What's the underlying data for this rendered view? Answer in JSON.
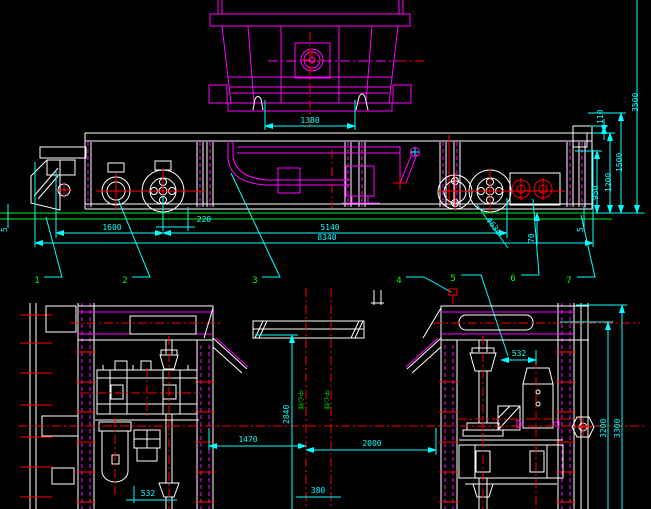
{
  "colors": {
    "background": "#000000",
    "structure_white": "#ffffff",
    "part_magenta": "#ff00ff",
    "dimension_cyan": "#00ffff",
    "centerline_red": "#ff0000",
    "ground_green": "#00ee00",
    "callout_green": "#00ff00"
  },
  "side_view": {
    "dims": {
      "hopper_seat_width": "1380",
      "axle_offset": "220",
      "end_overhang": "1600",
      "wheel_base": "5140",
      "overall_length": "8340",
      "overall_height": "3500",
      "lip_height": "110",
      "height_1500": "1500",
      "deck_height": "1200",
      "height_950": "950",
      "rail_gap_left": "5",
      "rail_gap_right": "5",
      "rail_head_height": "70",
      "wheel_diameter": "Φ630"
    },
    "callouts": [
      "1",
      "2",
      "3",
      "4",
      "5",
      "6",
      "7"
    ]
  },
  "end_view": {
    "dims": {
      "motor_offset": "532",
      "jack_offset": "532",
      "bay_width_left": "1470",
      "bay_width_right": "2000",
      "frame_height": "2840",
      "centerline_gap": "380",
      "inner_width": "3200",
      "outer_width": "3300"
    },
    "centerlines": {
      "left_label": "中心线",
      "right_label": "中心线"
    }
  }
}
